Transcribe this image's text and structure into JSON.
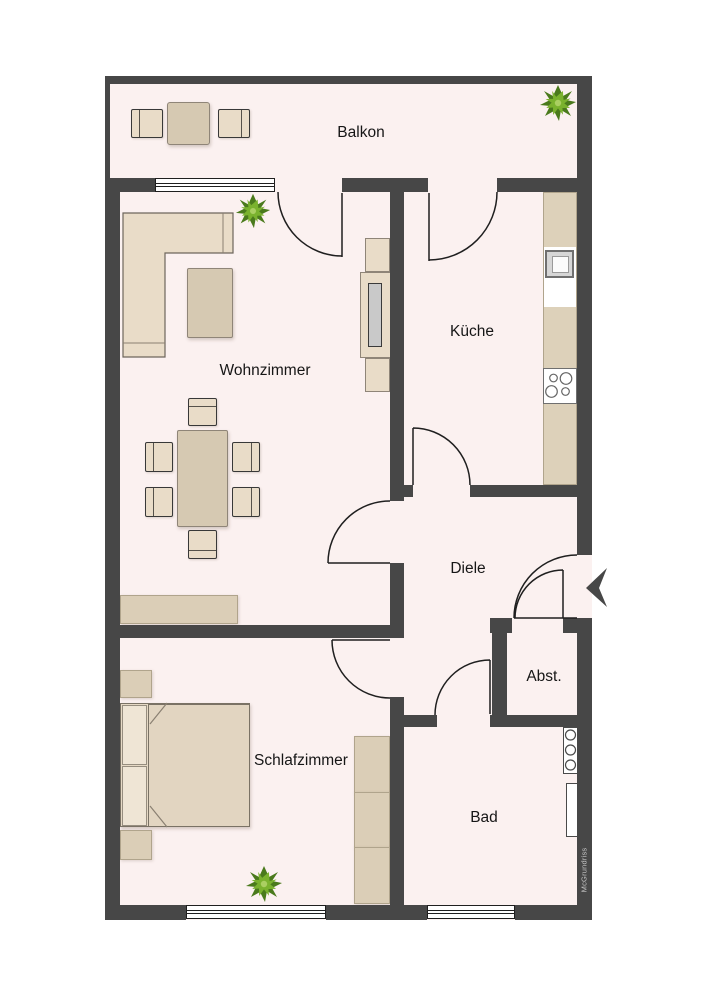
{
  "rooms": {
    "balkon": {
      "label": "Balkon"
    },
    "wohnzimmer": {
      "label": "Wohnzimmer"
    },
    "kueche": {
      "label": "Küche"
    },
    "diele": {
      "label": "Diele"
    },
    "abstellraum": {
      "label": "Abst."
    },
    "schlafzimmer": {
      "label": "Schlafzimmer"
    },
    "bad": {
      "label": "Bad"
    }
  },
  "watermark": {
    "label": "McGrundriss"
  },
  "colors": {
    "wall": "#474747",
    "floor": "#fbf1f0",
    "outline": "#1f1f1f",
    "furniture": "#e9dcc8",
    "furniture_mid": "#d6c9b2",
    "cabinet": "#dbceb7",
    "text": "#161616",
    "watermark": "#c4c4c4",
    "plant_dark": "#4a7a1c",
    "plant_mid": "#7ab22e",
    "plant_light": "#aacf62"
  },
  "icons": {
    "plant-icon": "potted plant, top view (8-leaf green star)",
    "entrance-arrow-icon": "black arrow marking apartment entrance, pointing left"
  }
}
